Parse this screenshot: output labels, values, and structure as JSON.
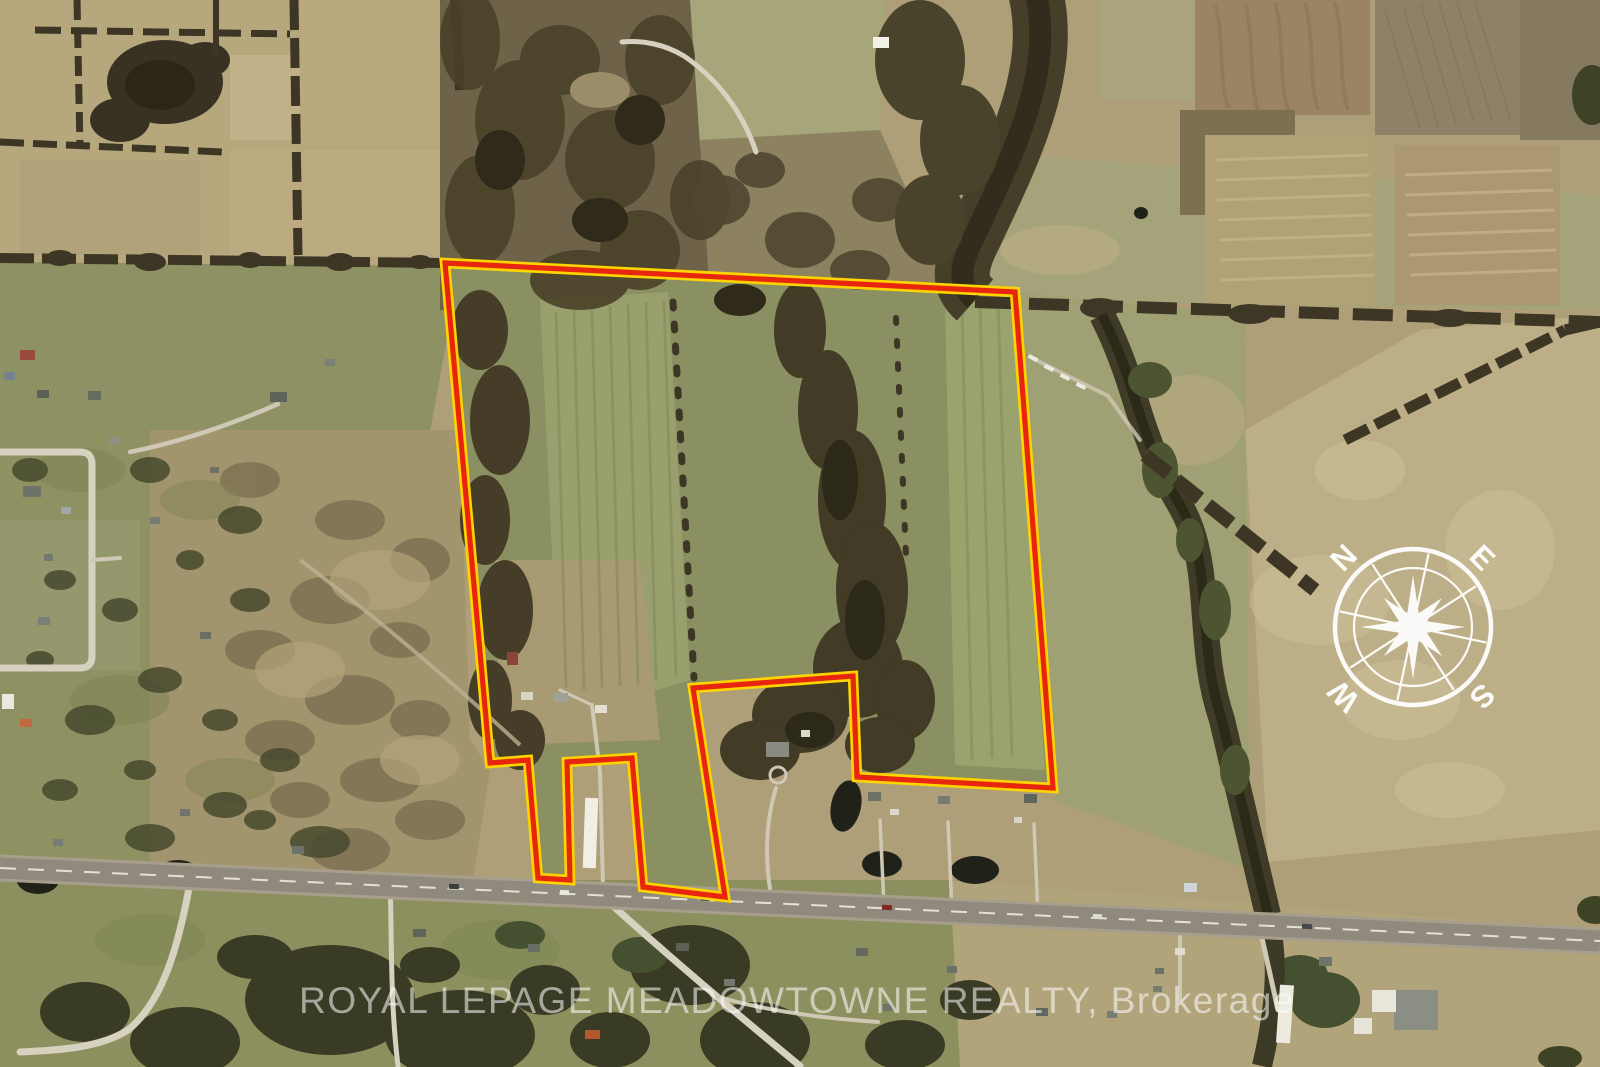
{
  "image": {
    "description": "Aerial satellite photo of rural farmland with an outlined property parcel, compass rose and brokerage watermark",
    "width_px": 1600,
    "height_px": 1067
  },
  "watermark": {
    "text": "ROYAL LEPAGE MEADOWTOWNE REALTY, Brokerage",
    "color": "#ffffff",
    "opacity": 0.55
  },
  "compass": {
    "north": "N",
    "east": "E",
    "south": "S",
    "west": "W",
    "color": "#ffffff"
  },
  "boundary": {
    "points": "445,263 1015,292 1053,788 857,777 853,676 693,688 725,897 643,887 632,758 567,762 570,880 538,878 528,760 490,763",
    "outline_color": "#ffd400",
    "line_color": "#e8260f",
    "interior_fill": "#8b9062"
  },
  "palette": {
    "field_tan": "#b7a77d",
    "field_olive": "#8e9163",
    "field_pale_green": "#a4a379",
    "plowed_brown": "#9a8464",
    "scrub": "#a2946d",
    "woods_dark": "#3a3323",
    "highway_asphalt": "#8f8a7d",
    "local_road": "#d7d1c0"
  }
}
